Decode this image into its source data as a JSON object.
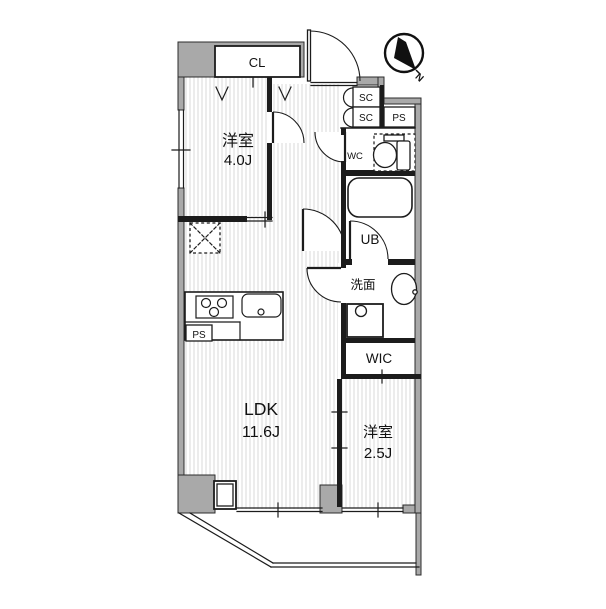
{
  "colors": {
    "bg": "#ffffff",
    "wall": "#a9a9a9",
    "line": "#1c1c1c",
    "hatch": "#d9d9d9"
  },
  "labels": {
    "cl": "CL",
    "sc_upper": "SC",
    "sc_lower": "SC",
    "ps_entry": "PS",
    "wc": "WC",
    "ub": "UB",
    "washroom": "洗面",
    "wic": "WIC",
    "ps_kitchen": "PS",
    "room1_name": "洋室",
    "room1_size": "4.0J",
    "ldk_name": "LDK",
    "ldk_size": "11.6J",
    "room2_name": "洋室",
    "room2_size": "2.5J",
    "compass_n": "N"
  }
}
